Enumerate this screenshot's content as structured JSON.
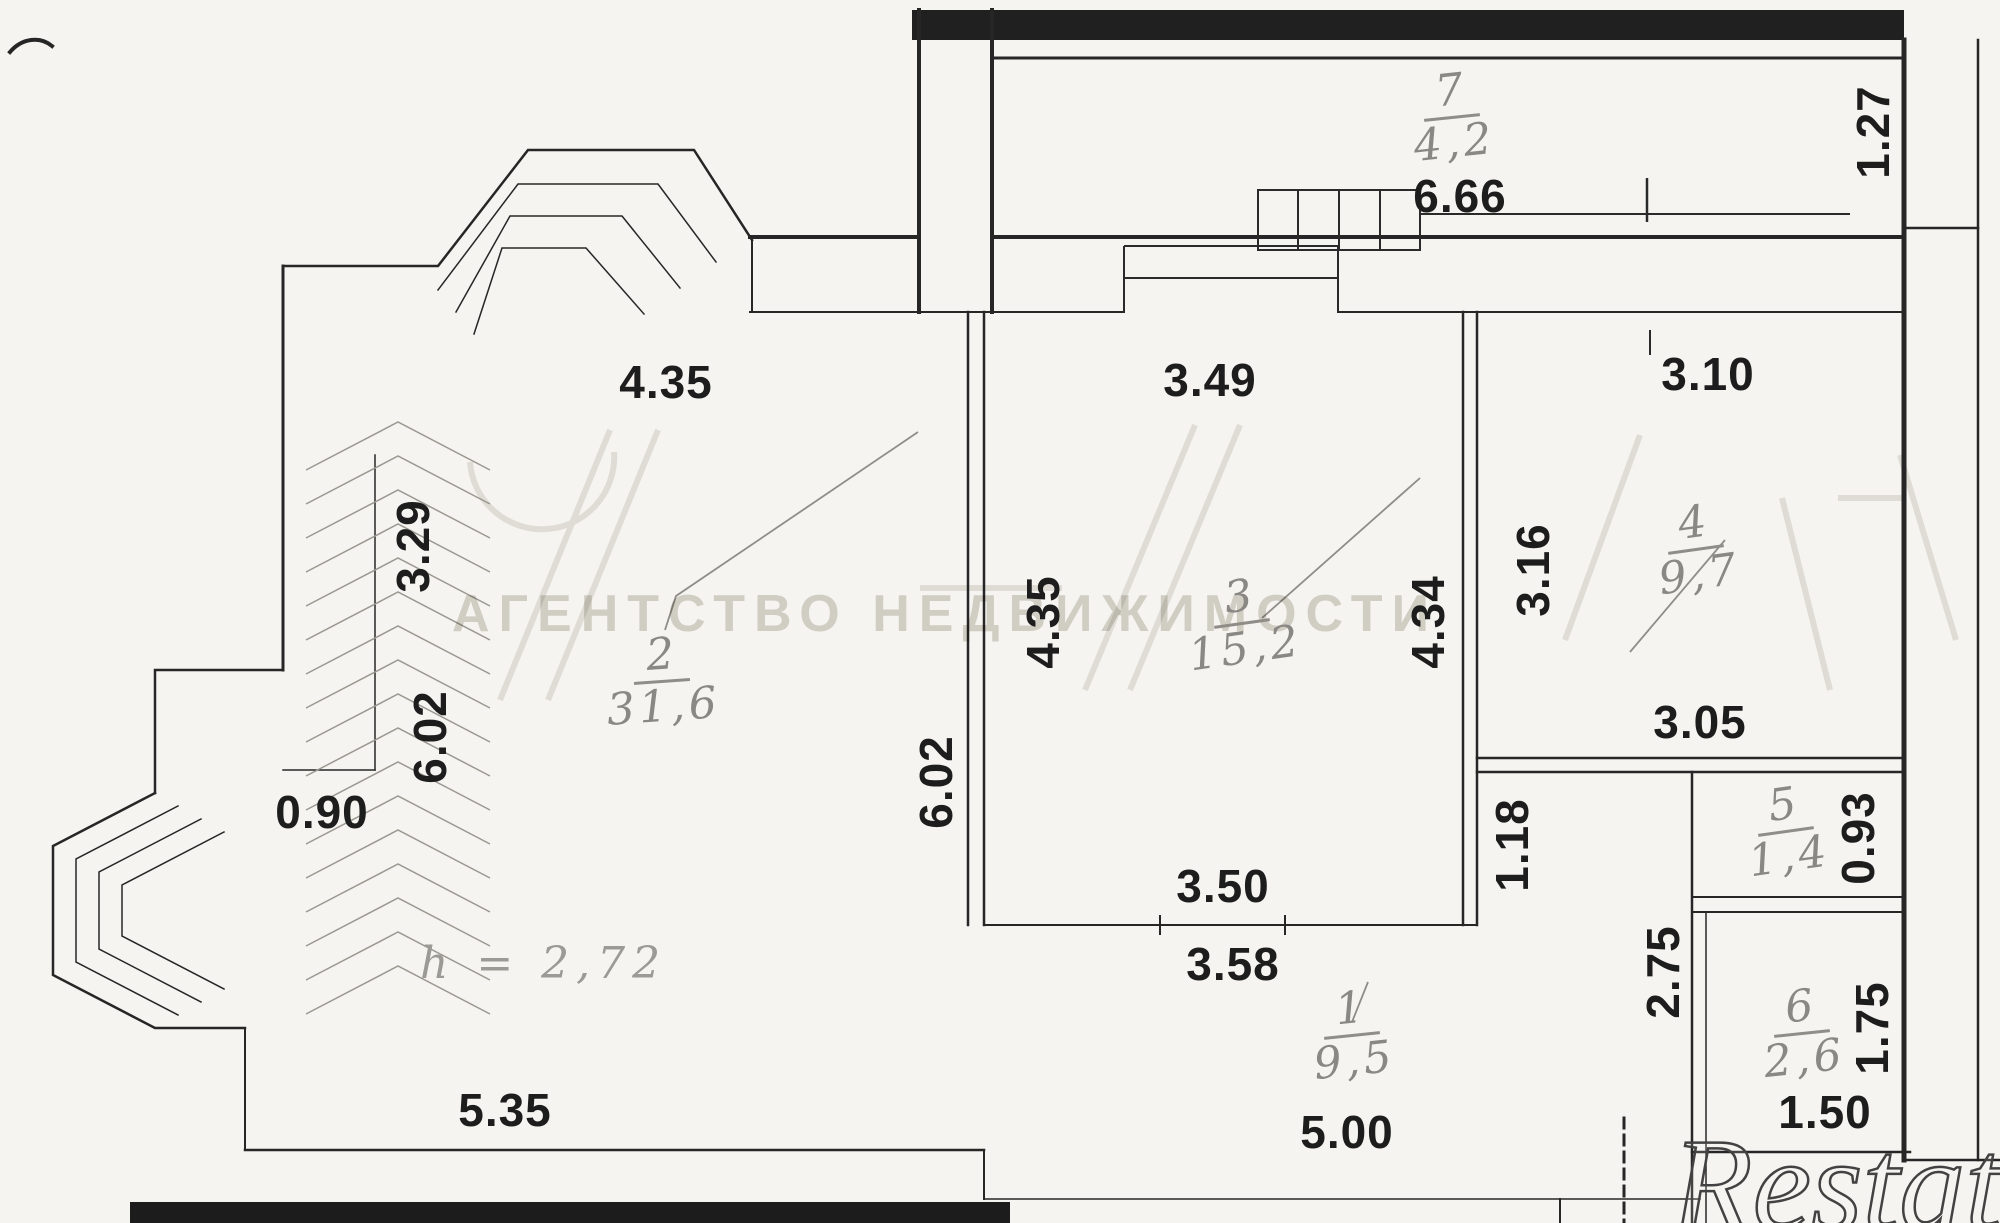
{
  "watermark": {
    "agency": "АГЕНТСТВО НЕДВИЖИМОСТИ",
    "brand": "Restate"
  },
  "height_note": "h = 2,72",
  "rooms": [
    {
      "number": "7",
      "area": "4,2"
    },
    {
      "number": "2",
      "area": "31,6"
    },
    {
      "number": "3",
      "area": "15,2"
    },
    {
      "number": "4",
      "area": "9,7"
    },
    {
      "number": "5",
      "area": "1,4"
    },
    {
      "number": "6",
      "area": "2,6"
    },
    {
      "number": "1",
      "area": "9,5"
    }
  ],
  "dims": {
    "w666": "6.66",
    "w435a": "4.35",
    "w349": "3.49",
    "w310": "3.10",
    "w127": "1.27",
    "w329": "3.29",
    "w602a": "6.02",
    "w602b": "6.02",
    "w090": "0.90",
    "w435b": "4.35",
    "w434": "4.34",
    "w316": "3.16",
    "w305": "3.05",
    "w118": "1.18",
    "w093": "0.93",
    "w350": "3.50",
    "w358": "3.58",
    "w275": "2.75",
    "w175": "1.75",
    "w535": "5.35",
    "w500": "5.00",
    "w150": "1.50"
  }
}
